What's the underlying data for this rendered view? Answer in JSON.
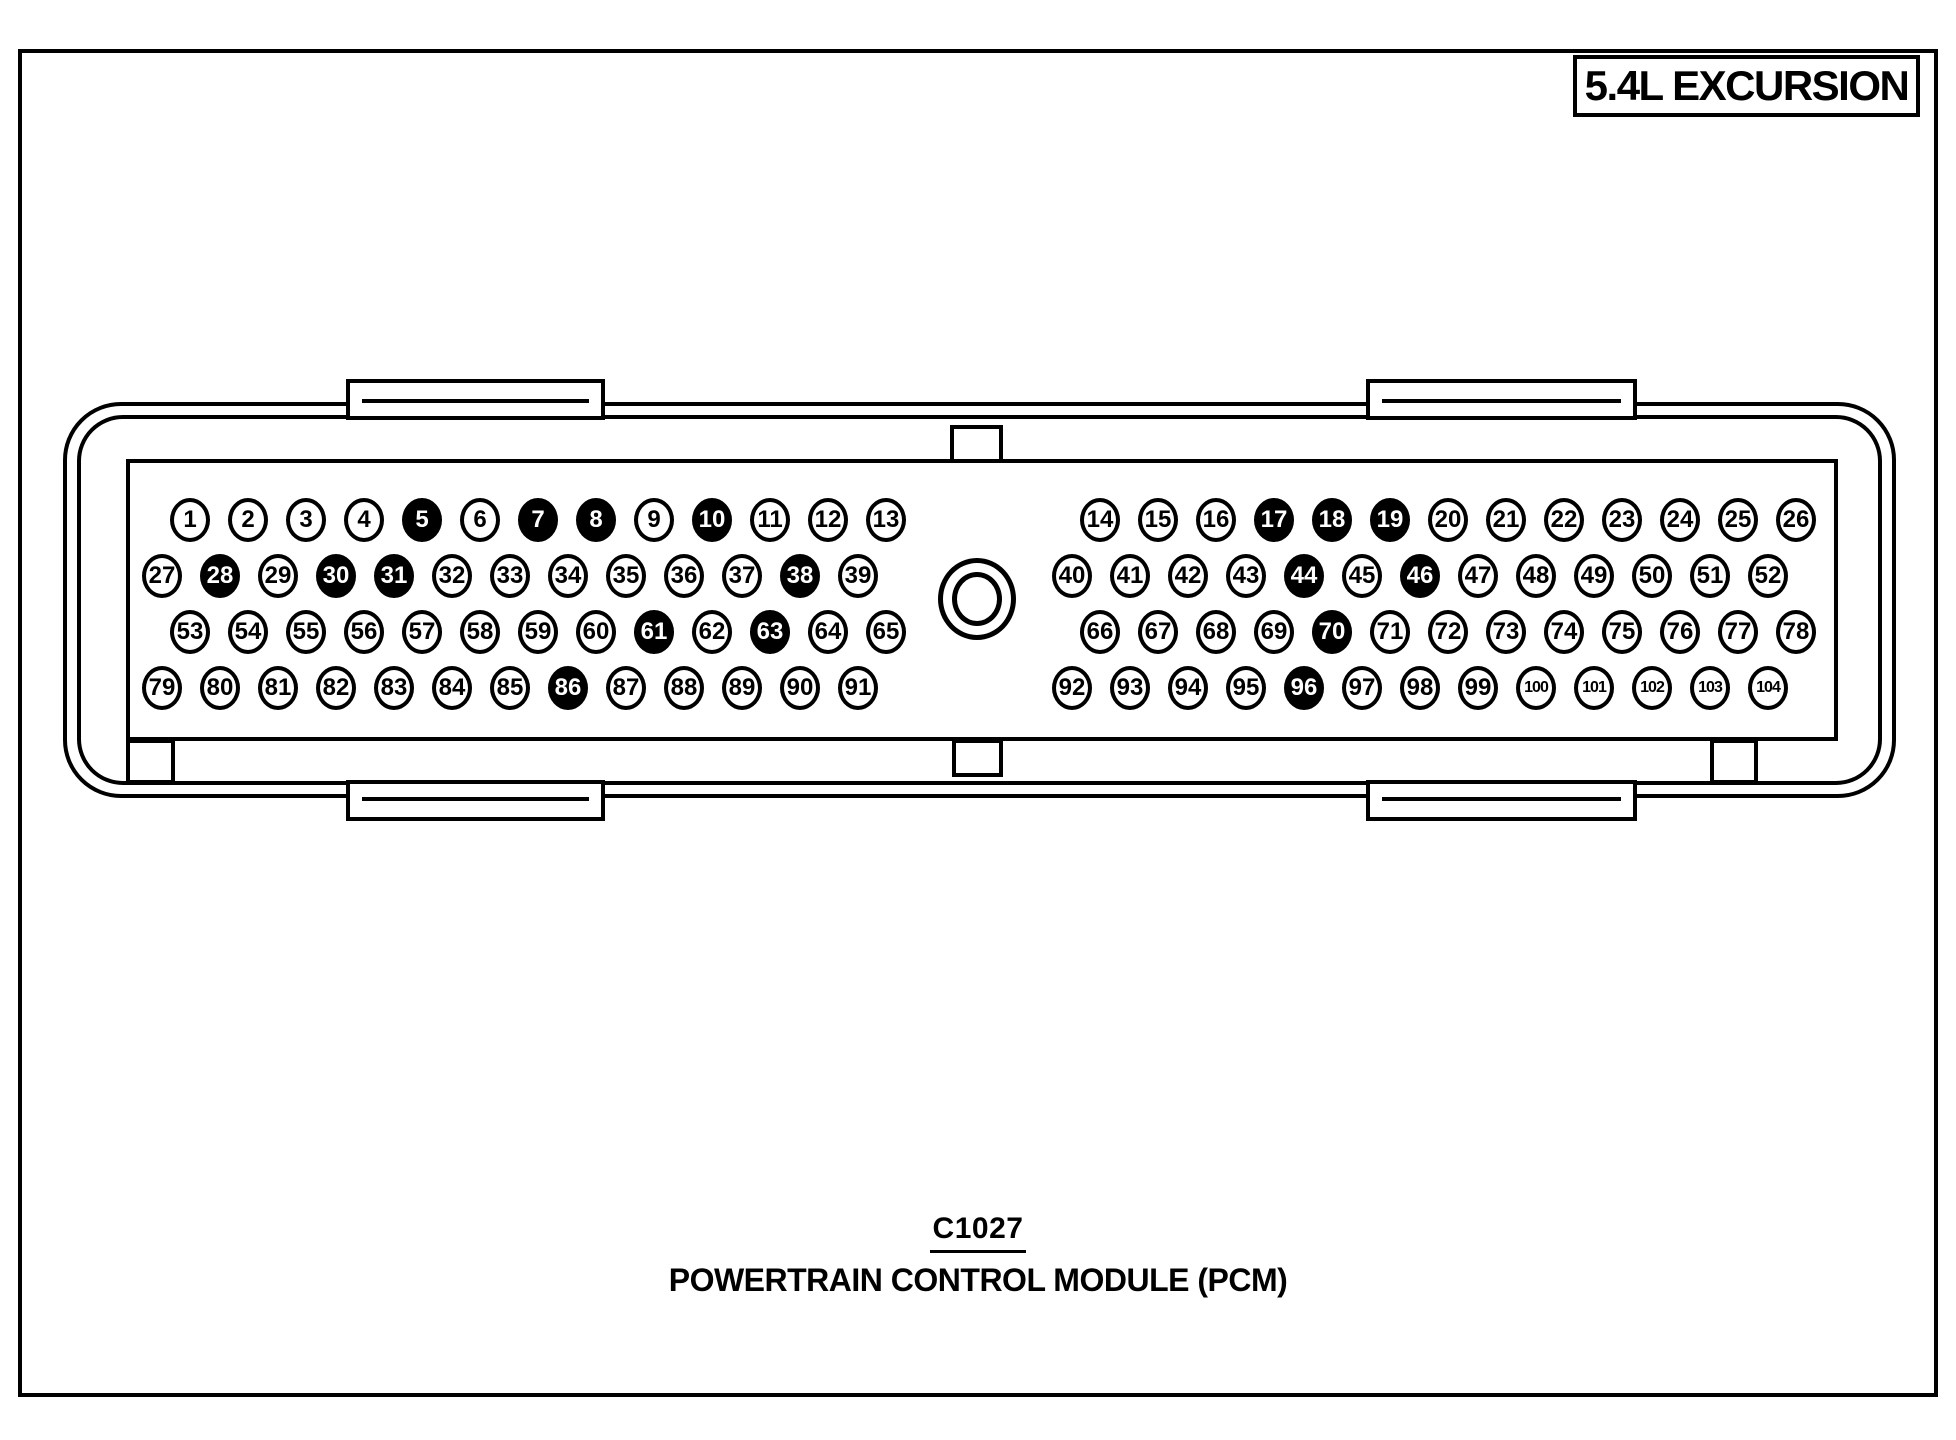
{
  "title_box": {
    "label": "5.4L EXCURSION"
  },
  "caption": {
    "connector_id": "C1027",
    "connector_name": "POWERTRAIN CONTROL MODULE (PCM)"
  },
  "colors": {
    "ink": "#000000",
    "paper": "#ffffff",
    "pin_open_bg": "#ffffff",
    "pin_open_text": "#000000",
    "pin_filled_bg": "#000000",
    "pin_filled_text": "#ffffff"
  },
  "connector": {
    "rows": [
      {
        "left": [
          1,
          2,
          3,
          4,
          5,
          6,
          7,
          8,
          9,
          10,
          11,
          12,
          13
        ],
        "right": [
          14,
          15,
          16,
          17,
          18,
          19,
          20,
          21,
          22,
          23,
          24,
          25,
          26
        ]
      },
      {
        "left": [
          27,
          28,
          29,
          30,
          31,
          32,
          33,
          34,
          35,
          36,
          37,
          38,
          39
        ],
        "right": [
          40,
          41,
          42,
          43,
          44,
          45,
          46,
          47,
          48,
          49,
          50,
          51,
          52
        ]
      },
      {
        "left": [
          53,
          54,
          55,
          56,
          57,
          58,
          59,
          60,
          61,
          62,
          63,
          64,
          65
        ],
        "right": [
          66,
          67,
          68,
          69,
          70,
          71,
          72,
          73,
          74,
          75,
          76,
          77,
          78
        ]
      },
      {
        "left": [
          79,
          80,
          81,
          82,
          83,
          84,
          85,
          86,
          87,
          88,
          89,
          90,
          91
        ],
        "right": [
          92,
          93,
          94,
          95,
          96,
          97,
          98,
          99,
          100,
          101,
          102,
          103,
          104
        ]
      }
    ],
    "filled_pins": [
      5,
      7,
      8,
      10,
      17,
      18,
      19,
      28,
      30,
      31,
      38,
      44,
      46,
      61,
      63,
      70,
      86,
      96
    ]
  }
}
